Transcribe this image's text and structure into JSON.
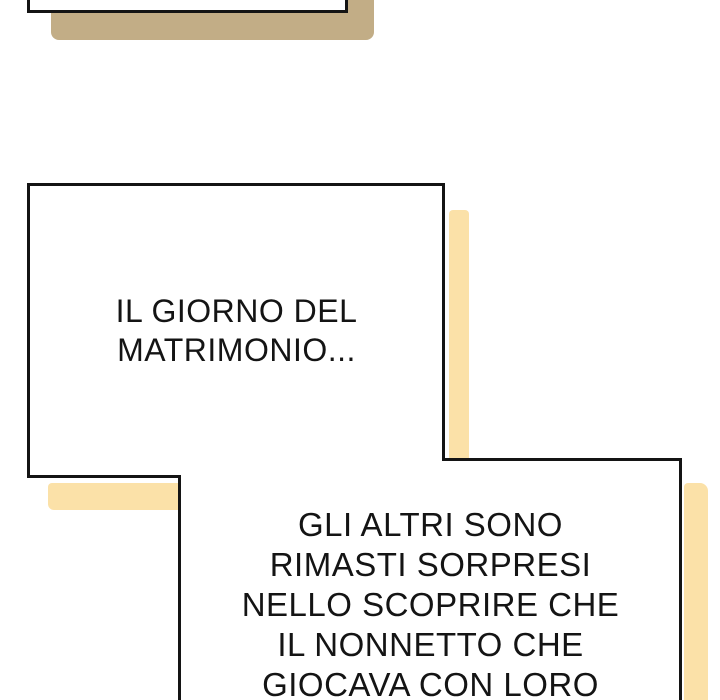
{
  "colors": {
    "paper": "#ffffff",
    "ink": "#141414",
    "shadow_yellow": "#FBE1A8",
    "shadow_tan": "#C2AD86"
  },
  "bubbles": {
    "middle": {
      "lines": [
        "IL GIORNO DEL",
        "MATRIMONIO..."
      ]
    },
    "bottom": {
      "lines": [
        "GLI ALTRI SONO",
        "RIMASTI SORPRESI",
        "NELLO SCOPRIRE CHE",
        "IL NONNETTO CHE",
        "GIOCAVA CON LORO"
      ]
    }
  }
}
